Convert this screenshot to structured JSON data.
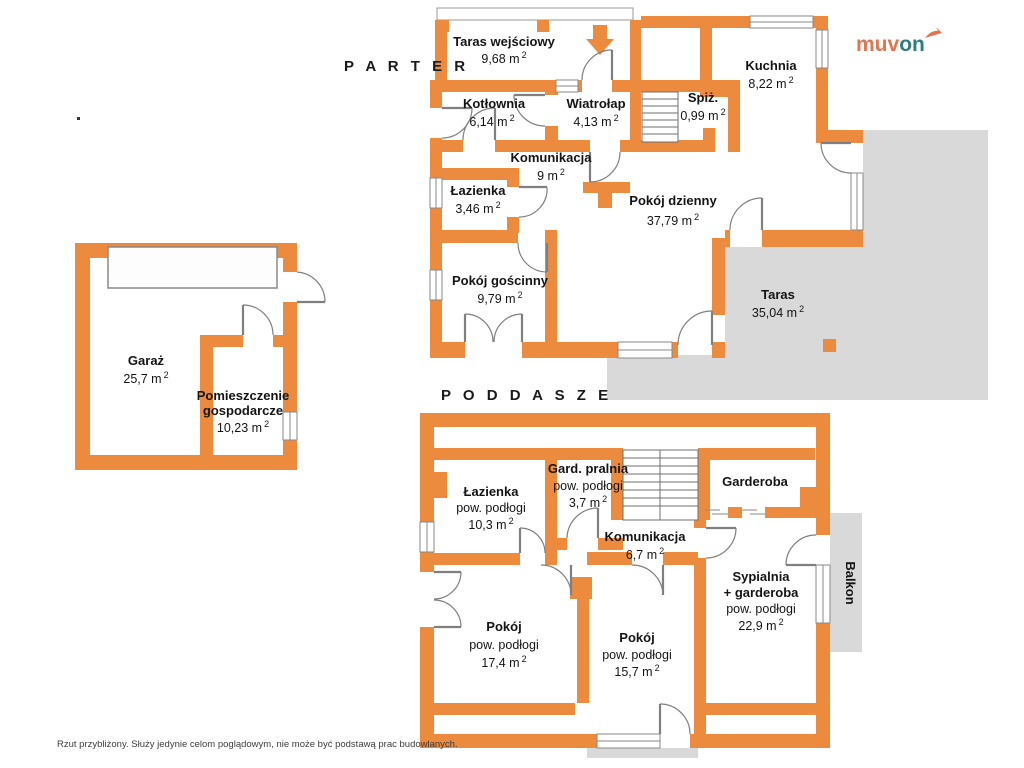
{
  "units": {
    "sup": "2"
  },
  "floors": {
    "parter": "P A R T E R",
    "poddasze": "P O D D A S Z E"
  },
  "logo": {
    "muv": "muv",
    "on": "on"
  },
  "disclaimer": "Rzut przybliżony. Służy jedynie celom poglądowym, nie może być podstawą prac budowlanych.",
  "parter_rooms": [
    {
      "name": "Taras wejściowy",
      "area": "9,68 m"
    },
    {
      "name": "Kotłownia",
      "area": "6,14 m"
    },
    {
      "name": "Wiatrołap",
      "area": "4,13 m"
    },
    {
      "name": "Spiż.",
      "area": "0,99 m"
    },
    {
      "name": "Kuchnia",
      "area": "8,22 m"
    },
    {
      "name": "Komunikacja",
      "area": "9 m"
    },
    {
      "name": "Łazienka",
      "area": "3,46 m"
    },
    {
      "name": "Pokój dzienny",
      "area": "37,79 m"
    },
    {
      "name": "Pokój gościnny",
      "area": "9,79 m"
    },
    {
      "name": "Taras",
      "area": "35,04 m"
    }
  ],
  "garage_rooms": [
    {
      "name": "Garaż",
      "area": "25,7 m"
    },
    {
      "name": "Pomieszczenie",
      "name2": "gospodarcze",
      "area": "10,23 m"
    }
  ],
  "poddasze_rooms": [
    {
      "name": "Łazienka",
      "sub": "pow. podłogi",
      "area": "10,3 m"
    },
    {
      "name": "Gard. pralnia",
      "sub": "pow. podłogi",
      "area": "3,7 m"
    },
    {
      "name": "Garderoba"
    },
    {
      "name": "Komunikacja",
      "area": "6,7 m"
    },
    {
      "name": "Sypialnia",
      "name2": "+ garderoba",
      "sub": "pow. podłogi",
      "area": "22,9 m"
    },
    {
      "name": "Pokój",
      "sub": "pow. podłogi",
      "area": "17,4 m"
    },
    {
      "name": "Pokój",
      "sub": "pow. podłogi",
      "area": "15,7 m"
    },
    {
      "name": "Balkon"
    }
  ]
}
